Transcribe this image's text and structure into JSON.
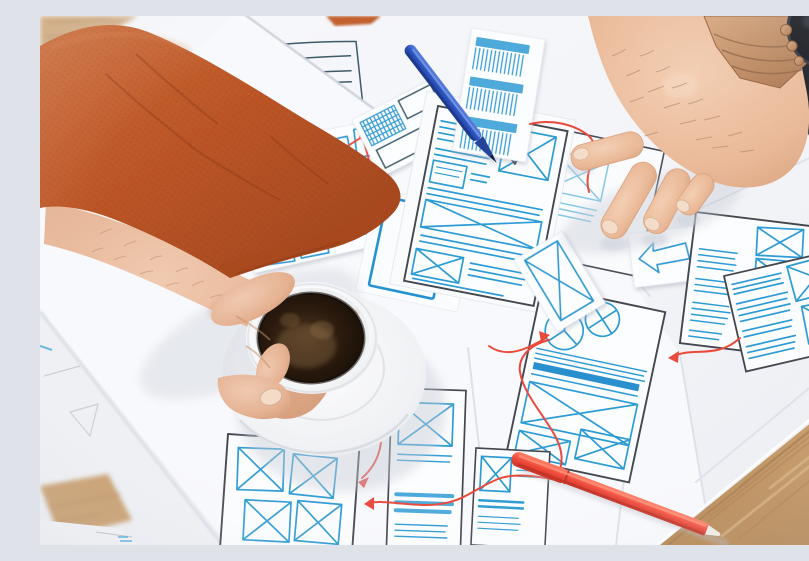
{
  "meta": {
    "type": "photograph",
    "description": "Top-down photo of a UX designer's desk: a left arm in an orange shirt holds a cup of black coffee, a right hand with a copper wristwatch points at hand-drawn app wireframe sketches in blue marker with red flow arrows, spread over overlapping white papers on a wooden table with a blue pen and a red marker."
  },
  "objects": {
    "desk": {
      "label": "wooden desk surface",
      "color": "#c79a68"
    },
    "papers": {
      "label": "overlapping white sheets with wireframe sketches",
      "color": "#f5f6f9"
    },
    "sleeve": {
      "label": "orange shirt sleeve on left arm",
      "color": "#bf5b2d"
    },
    "left_hand": {
      "label": "left hand holding the coffee cup"
    },
    "right_hand": {
      "label": "right hand pointing at wireframes"
    },
    "watch": {
      "label": "wristwatch with dark face and copper band",
      "band_color": "#c18a66",
      "face_color": "#14161c"
    },
    "coffee_cup": {
      "label": "white cup of black coffee on a white saucer",
      "coffee_color": "#2b1b10"
    },
    "blue_pen": {
      "label": "blue pen lying across the sketches",
      "color": "#2d54c0"
    },
    "red_pen": {
      "label": "red marker pen at bottom right",
      "color": "#f14c3c"
    },
    "tablet": {
      "label": "dark device corner at top right",
      "color": "#1a1b20"
    },
    "sketches": {
      "label": "blue marker wireframe sketches with red connector arrows",
      "ink_blue": "#2d9bd4",
      "ink_dark": "#43474f",
      "ink_red": "#ea4a3d"
    }
  }
}
